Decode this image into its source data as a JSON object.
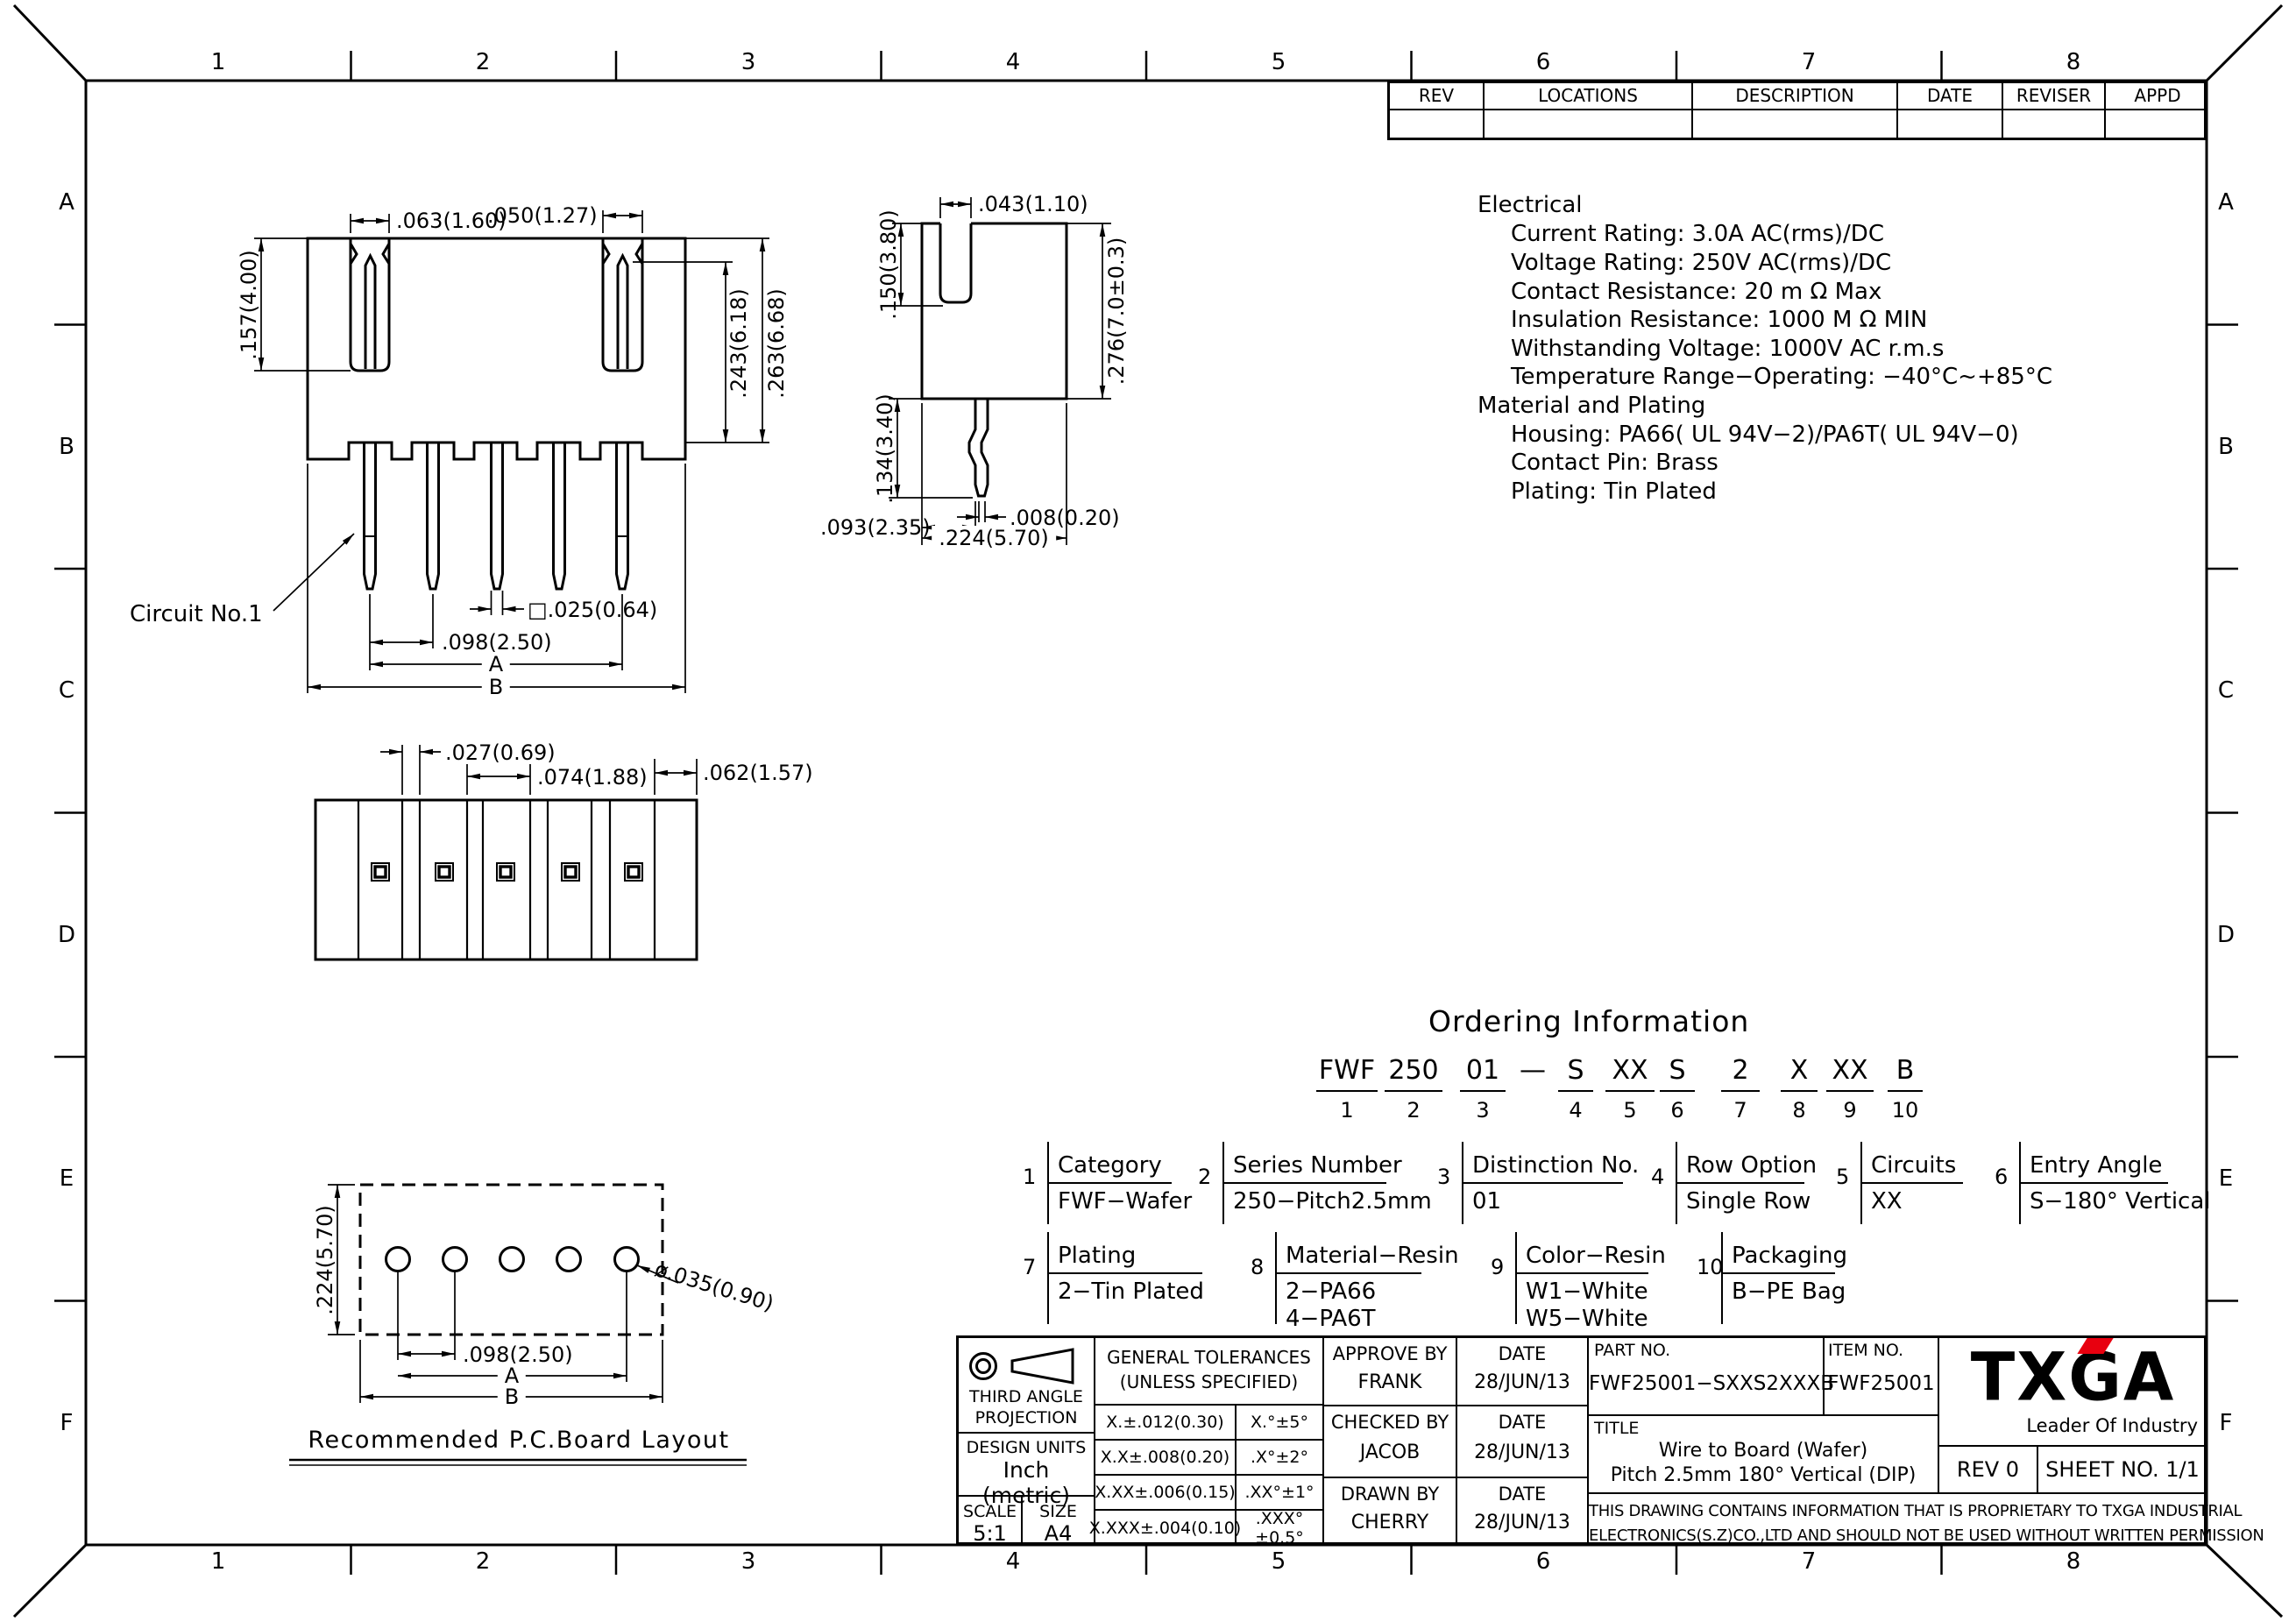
{
  "sheet": {
    "cols": [
      "1",
      "2",
      "3",
      "4",
      "5",
      "6",
      "7",
      "8"
    ],
    "rows": [
      "A",
      "B",
      "C",
      "D",
      "E",
      "F"
    ]
  },
  "revision_table": {
    "headers": [
      "REV",
      "LOCATIONS",
      "DESCRIPTION",
      "DATE",
      "REVISER",
      "APPD"
    ]
  },
  "specs": {
    "electrical_title": "Electrical",
    "electrical": [
      "Current Rating: 3.0A  AC(rms)/DC",
      "Voltage Rating: 250V  AC(rms)/DC",
      "Contact Resistance: 20 m Ω Max",
      "Insulation Resistance: 1000 M Ω MIN",
      "Withstanding Voltage: 1000V AC r.m.s",
      "Temperature Range−Operating: −40°C~+85°C"
    ],
    "material_title": "Material and Plating",
    "material": [
      "Housing: PA66( UL 94V−2)/PA6T( UL 94V−0)",
      "Contact Pin: Brass",
      "Plating: Tin Plated"
    ]
  },
  "front_view": {
    "circuit_label": "Circuit No.1",
    "dims": {
      "slot_left": ".063(1.60)",
      "slot_right": ".050(1.27)",
      "height_left": ".157(4.00)",
      "height_inner": ".243(6.18)",
      "height_outer": ".263(6.68)",
      "pin_square": "□.025(0.64)",
      "pitch": ".098(2.50)",
      "span_a": "A",
      "span_b": "B"
    }
  },
  "side_view": {
    "dims": {
      "slot_width": ".043(1.10)",
      "slot_depth": ".150(3.80)",
      "body_height": ".276(7.0±0.3)",
      "pin_length": ".134(3.40)",
      "pin_thickness": ".008(0.20)",
      "pin_offset": ".093(2.35)",
      "body_width": ".224(5.70)"
    }
  },
  "bottom_view": {
    "dims": {
      "groove": ".027(0.69)",
      "cell": ".074(1.88)",
      "margin": ".062(1.57)"
    }
  },
  "pcb_layout": {
    "caption": "Recommended P.C.Board Layout",
    "dims": {
      "depth": ".224(5.70)",
      "pitch": ".098(2.50)",
      "span_a": "A",
      "span_b": "B",
      "hole": "ø.035(0.90)"
    }
  },
  "ordering": {
    "title": "Ordering Information",
    "code": [
      {
        "text": "FWF",
        "num": "1"
      },
      {
        "text": "250",
        "num": "2"
      },
      {
        "text": "01",
        "num": "3"
      },
      {
        "text": "—",
        "num": ""
      },
      {
        "text": "S",
        "num": "4"
      },
      {
        "text": "XX",
        "num": "5"
      },
      {
        "text": "S",
        "num": "6"
      },
      {
        "text": "2",
        "num": "7"
      },
      {
        "text": "X",
        "num": "8"
      },
      {
        "text": "XX",
        "num": "9"
      },
      {
        "text": "B",
        "num": "10"
      }
    ],
    "groups": [
      {
        "num": "1",
        "label": "Category",
        "values": [
          "FWF−Wafer"
        ]
      },
      {
        "num": "2",
        "label": "Series Number",
        "values": [
          "250−Pitch2.5mm"
        ]
      },
      {
        "num": "3",
        "label": "Distinction No.",
        "values": [
          "01"
        ]
      },
      {
        "num": "4",
        "label": "Row Option",
        "values": [
          "Single Row"
        ]
      },
      {
        "num": "5",
        "label": "Circuits",
        "values": [
          "XX"
        ]
      },
      {
        "num": "6",
        "label": "Entry Angle",
        "values": [
          "S−180° Vertical"
        ]
      },
      {
        "num": "7",
        "label": "Plating",
        "values": [
          "2−Tin Plated"
        ]
      },
      {
        "num": "8",
        "label": "Material−Resin",
        "values": [
          "2−PA66",
          "4−PA6T"
        ]
      },
      {
        "num": "9",
        "label": "Color−Resin",
        "values": [
          "W1−White",
          "W5−White"
        ]
      },
      {
        "num": "10",
        "label": "Packaging",
        "values": [
          "B−PE Bag"
        ]
      }
    ]
  },
  "title_block": {
    "projection": {
      "line1": "THIRD ANGLE",
      "line2": "PROJECTION"
    },
    "design_units": {
      "label": "DESIGN UNITS",
      "value": "Inch (metric)"
    },
    "scale": {
      "label": "SCALE",
      "value": "5:1"
    },
    "size": {
      "label": "SIZE",
      "value": "A4"
    },
    "tolerances": {
      "title1": "GENERAL TOLERANCES",
      "title2": "(UNLESS SPECIFIED)",
      "rows": [
        {
          "linear": "X.±.012(0.30)",
          "angular": "X.°±5°"
        },
        {
          "linear": "X.X±.008(0.20)",
          "angular": ".X°±2°"
        },
        {
          "linear": "X.XX±.006(0.15)",
          "angular": ".XX°±1°"
        },
        {
          "linear": "X.XXX±.004(0.10)",
          "angular": ".XXX°±0.5°"
        }
      ]
    },
    "approvals": [
      {
        "role": "APPROVE BY",
        "name": "FRANK",
        "date_label": "DATE",
        "date": "28/JUN/13"
      },
      {
        "role": "CHECKED BY",
        "name": "JACOB",
        "date_label": "DATE",
        "date": "28/JUN/13"
      },
      {
        "role": "DRAWN BY",
        "name": "CHERRY",
        "date_label": "DATE",
        "date": "28/JUN/13"
      }
    ],
    "part_no": {
      "label": "PART NO.",
      "value": "FWF25001−SXXS2XXXB"
    },
    "item_no": {
      "label": "ITEM NO.",
      "value": "FWF25001"
    },
    "doc_title": {
      "label": "TITLE",
      "line1": "Wire to Board (Wafer)",
      "line2": "Pitch 2.5mm 180° Vertical (DIP)"
    },
    "logo": {
      "text": "TXGA",
      "tagline": "Leader Of Industry",
      "accent_color": "#e8000f"
    },
    "rev": "REV 0",
    "sheet_no": "SHEET NO. 1/1",
    "proprietary": {
      "line1": "THIS DRAWING CONTAINS INFORMATION THAT IS PROPRIETARY TO TXGA INDUSTRIAL",
      "line2": "ELECTRONICS(S.Z)CO.,LTD AND SHOULD NOT BE USED WITHOUT WRITTEN PERMISSION"
    }
  }
}
